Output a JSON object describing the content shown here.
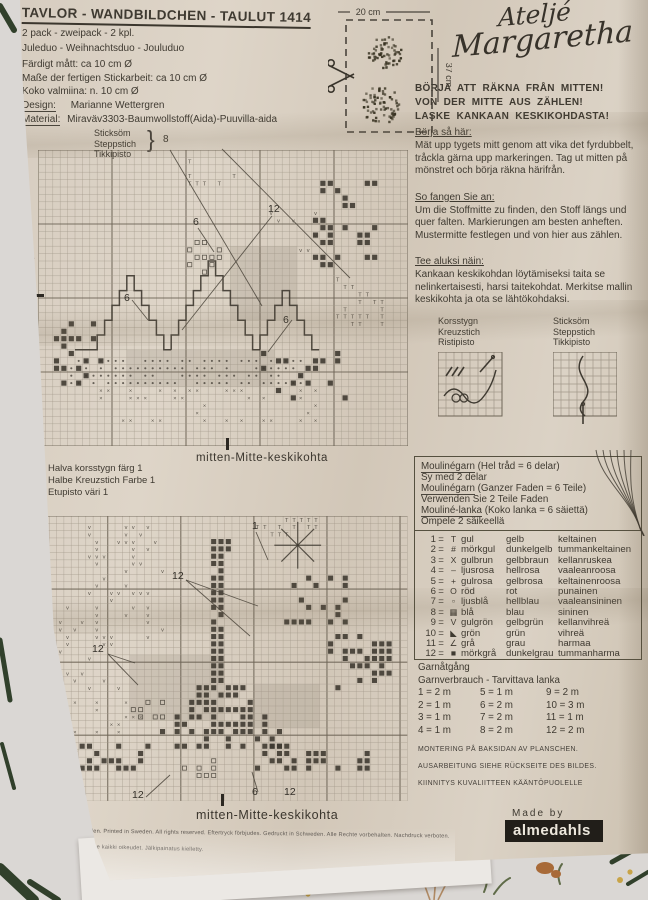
{
  "header": {
    "title": "TAVLOR - WANDBILDCHEN - TAULUT 1414",
    "meta_lines": [
      "2 pack - zweipack - 2 kpl.",
      "Juleduo - Weihnachtsduo - Jouluduo"
    ],
    "size_lines": [
      "Färdigt mått: ca 10 cm Ø",
      "Maße der fertigen Stickarbeit: ca 10 cm Ø",
      "Koko valmiina: n. 10 cm Ø"
    ],
    "design_label": "Design:",
    "design_value": "Marianne Wettergren",
    "material_label": "Material:",
    "material_value": "Miraväv3303-Baumwollstoff(Aida)-Puuvilla-aida"
  },
  "brand": {
    "name_line1": "Ateljé",
    "name_line2": "Margaretha",
    "made_by": "Made by",
    "manufacturer": "almedahls"
  },
  "cut_diagram": {
    "width_label": "20 cm",
    "height_label": "37 cm"
  },
  "start_banner": {
    "lines": [
      "BÖRJA ATT RÄKNA FRÅN MITTEN!",
      "VON DER MITTE AUS ZÄHLEN!",
      "LASKE KANKAAN KESKIKOHDASTA!"
    ]
  },
  "instructions": [
    {
      "heading": "Börja så här:",
      "body": "Mät upp tygets mitt genom att vika det fyrdubbelt, tråckla gärna upp markeringen. Tag ut mitten på mönstret och börja räkna härifrån."
    },
    {
      "heading": "So fangen Sie an:",
      "body": "Um die Stoffmitte zu finden, den Stoff längs und quer falten. Markierungen am besten anheften. Mustermitte festlegen und von hier aus zählen."
    },
    {
      "heading": "Tee aluksi näin:",
      "body": "Kankaan keskikohdan löytämiseksi taita se nelinkertaisesti, harsi taitekohdat. Merkitse mallin keskikohta ja ota se lähtökohdaksi."
    }
  ],
  "stitch_types": {
    "cross": [
      "Korsstygn",
      "Kreuzstich",
      "Ristipisto"
    ],
    "back": [
      "Sticksöm",
      "Steppstich",
      "Tikkipisto"
    ]
  },
  "chart_top": {
    "backstitch_brace": "}",
    "backstitch_color_num": "8",
    "annotations": [
      "12",
      "6",
      "6",
      "6"
    ],
    "center_label": "mitten-Mitte-keskikohta",
    "side_label": "mitten-Mitte-keskikohta"
  },
  "half_cross_note": {
    "lines": [
      "Halva  korsstygn färg 1",
      "Halbe Kreuzstich Farbe 1",
      "Etupisto väri 1"
    ]
  },
  "chart_bottom": {
    "annotations": [
      "1",
      "12",
      "12",
      "12",
      "6",
      "12"
    ],
    "center_label": "mitten-Mitte-keskikohta",
    "side_label": "mitten-Mitte-keskikohta"
  },
  "thread_info": {
    "eq": "=",
    "rows": [
      {
        "label": "Moulinégarn",
        "note": "(Hel tråd = 6 delar)",
        "extra": "Sy med 2 delar"
      },
      {
        "label": "Moulinégarn",
        "note": "(Ganzer Faden = 6 Teile)",
        "extra": "Verwenden Sie 2 Teile Faden"
      },
      {
        "label": "Mouliné-lanka",
        "note": "(Koko lanka = 6 säiettä)",
        "extra": "Ompele 2 säikeellä"
      }
    ]
  },
  "color_key": [
    {
      "num": "1",
      "symbol": "T",
      "sv": "gul",
      "de": "gelb",
      "fi": "keltainen"
    },
    {
      "num": "2",
      "symbol": "#",
      "sv": "mörkgul",
      "de": "dunkelgelb",
      "fi": "tummankeltainen"
    },
    {
      "num": "3",
      "symbol": "X",
      "sv": "gulbrun",
      "de": "gelbbraun",
      "fi": "kellanruskea"
    },
    {
      "num": "4",
      "symbol": "–",
      "sv": "ljusrosa",
      "de": "hellrosa",
      "fi": "vaaleanroosa"
    },
    {
      "num": "5",
      "symbol": "+",
      "sv": "gulrosa",
      "de": "gelbrosa",
      "fi": "keltainenroosa"
    },
    {
      "num": "6",
      "symbol": "O",
      "sv": "röd",
      "de": "rot",
      "fi": "punainen"
    },
    {
      "num": "7",
      "symbol": "▫",
      "sv": "ljusblå",
      "de": "hellblau",
      "fi": "vaaleansininen"
    },
    {
      "num": "8",
      "symbol": "▦",
      "sv": "blå",
      "de": "blau",
      "fi": "sininen"
    },
    {
      "num": "9",
      "symbol": "V",
      "sv": "gulgrön",
      "de": "gelbgrün",
      "fi": "kellanvihreä"
    },
    {
      "num": "10",
      "symbol": "◣",
      "sv": "grön",
      "de": "grün",
      "fi": "vihreä"
    },
    {
      "num": "11",
      "symbol": "∠",
      "sv": "grå",
      "de": "grau",
      "fi": "harmaa"
    },
    {
      "num": "12",
      "symbol": "■",
      "sv": "mörkgrå",
      "de": "dunkelgrau",
      "fi": "tummanharma"
    }
  ],
  "yarn_usage": {
    "title": "Garnåtgång",
    "subtitle": "Garnverbrauch - Tarvittava lanka",
    "entries": [
      "1 = 2 m",
      "5 = 1 m",
      "9 = 2 m",
      "2 = 1 m",
      "6 = 2 m",
      "10 = 3 m",
      "3 = 1 m",
      "7 = 2 m",
      "11 = 1 m",
      "4 = 1 m",
      "8 = 2 m",
      "12 = 2 m"
    ]
  },
  "mounting": {
    "lines": [
      "MONTERING PÅ BAKSIDAN AV PLANSCHEN.",
      "AUSARBEITUNG SIEHE RÜCKSEITE DES BILDES.",
      "KIINNITYS KUVALIITTEEN KÄÄNTÖPUOLELLE"
    ]
  },
  "fine_print": {
    "lines": [
      "in Sweden.  Printed in Sweden.  All rights reserved.  Eftertryck förbjudes.  Gedruckt in Schweden.  Alle Rechte vorbehalten.  Nachdruck verboten.",
      "Ruotsissa.  Pidätämme kaikki oikeudet.  Jälkipainatus kielletty."
    ]
  },
  "colors": {
    "paper": "#d8cec1",
    "ink": "#3f3a31",
    "grid_light": "#a2988a",
    "grid_heavy": "#6e6557",
    "logo_ink": "#37322a",
    "badge_bg": "#211e19",
    "badge_text": "#ece7dc"
  }
}
